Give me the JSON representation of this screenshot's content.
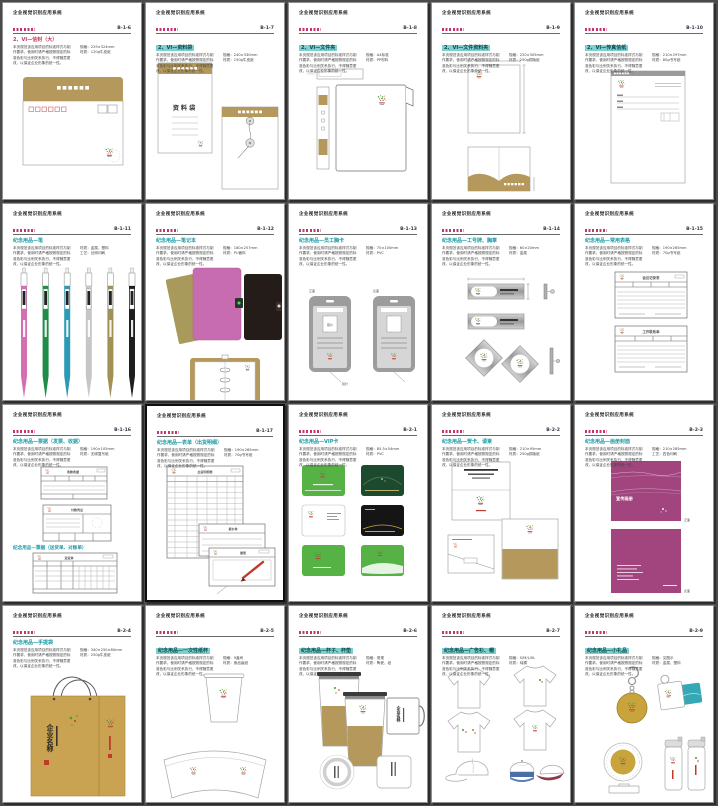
{
  "manual_title": "企业视觉识别应用系统",
  "common": {
    "desc": "本页规范该应用项目的标准样式与制作要求，使用时请严格按照规定的标准色彩与比例关系执行，不得随意更改，以保证企业形象的统一性。",
    "front_label": "正面",
    "back_label": "反面"
  },
  "colors": {
    "accent_red": "#c3356f",
    "accent_cyan": "#189aa6",
    "highlight_cyan": "#7fd0cf",
    "gold": "#b5995c",
    "card_green": "#56b244",
    "card_dark_green": "#1c4a2e",
    "panel_magenta": "#a2457e",
    "notebook_pink": "#c76cb0",
    "pen_colors": [
      "#d470b2",
      "#1f8c47",
      "#2b9ab4",
      "#c6c6c6",
      "#a29155",
      "#1e1e1e"
    ],
    "tag_teal": "#35a7b5",
    "cap_blue": "#4a6fa5",
    "cap_maroon": "#8e3a4a"
  },
  "pages": [
    {
      "code": "B-1-6",
      "title": "2、VI—信封（大）",
      "tstyle": "red",
      "spec1": "规格：229×324mm",
      "spec2": "材质：120g牛皮纸"
    },
    {
      "code": "B-1-7",
      "title": "2、VI—资料袋",
      "tstyle": "hl",
      "spec1": "规格：240×330mm",
      "spec2": "材质：150g牛皮纸",
      "labels": {
        "bag": "资料袋"
      }
    },
    {
      "code": "B-1-8",
      "title": "2、VI—文件夹",
      "tstyle": "hl",
      "spec1": "规格：A4标准",
      "spec2": "材质：PP材料"
    },
    {
      "code": "B-1-9",
      "title": "2、VI—文件资料夹",
      "tstyle": "hl",
      "spec1": "规格：220×305mm",
      "spec2": "材质：250g铜版纸"
    },
    {
      "code": "B-1-10",
      "title": "2、VI—传真信纸",
      "tstyle": "hl",
      "spec1": "规格：210×297mm",
      "spec2": "材质：80g书写纸"
    },
    {
      "code": "B-1-11",
      "title": "纪念用品—笔",
      "tstyle": "cyan",
      "spec1": "材质：金属、塑料",
      "spec2": "工艺：丝网印刷"
    },
    {
      "code": "B-1-12",
      "title": "纪念用品—笔记本",
      "tstyle": "cyan",
      "spec1": "规格：180×257mm",
      "spec2": "材质：PU面料"
    },
    {
      "code": "B-1-13",
      "title": "纪念用品—员工胸卡",
      "tstyle": "cyan",
      "spec1": "规格：70×100mm",
      "spec2": "材质：PVC",
      "labels": {
        "photo": "照片",
        "front": "正面",
        "back": "反面",
        "pin": "别针"
      }
    },
    {
      "code": "B-1-14",
      "title": "纪念用品—工号牌、胸章",
      "tstyle": "cyan",
      "spec1": "规格：60×20mm",
      "spec2": "材质：金属"
    },
    {
      "code": "B-1-15",
      "title": "纪念用品—常用表格",
      "tstyle": "cyan",
      "spec1": "规格：190×265mm",
      "spec2": "材质：70g书写纸",
      "labels": {
        "form1": "会议记录表",
        "form2": "工作联系单"
      }
    },
    {
      "code": "B-1-16",
      "title": "纪念用品—票据（发票、收据）",
      "tstyle": "cyan",
      "title2": "纪念用品—票据（送货单、对账单）",
      "spec1": "规格：190×105mm",
      "spec2": "材质：无碳复写纸",
      "labels": {
        "form1": "收款收据",
        "form2": "付款凭证",
        "form3": "送货单"
      }
    },
    {
      "code": "B-1-17",
      "title": "纪念用品—表单（出货明细）",
      "tstyle": "cyan",
      "spec1": "规格：190×265mm",
      "spec2": "材质：70g书写纸",
      "labels": {
        "table": "出货明细表",
        "form2": "报价单",
        "form3": "便笺"
      }
    },
    {
      "code": "B-2-1",
      "title": "纪念用品—VIP卡",
      "tstyle": "cyan",
      "spec1": "规格：85.5×54mm",
      "spec2": "材质：PVC"
    },
    {
      "code": "B-2-2",
      "title": "纪念用品—贺卡、请柬",
      "tstyle": "cyan",
      "spec1": "规格：210×95mm",
      "spec2": "材质：250g铜版纸"
    },
    {
      "code": "B-2-3",
      "title": "纪念用品—画册封面",
      "tstyle": "cyan",
      "spec1": "规格：210×285mm",
      "spec2": "工艺：四色印刷",
      "labels": {
        "cover": "宣传画册",
        "front": "正面",
        "back": "反面"
      }
    },
    {
      "code": "B-2-4",
      "title": "纪念用品—手提袋",
      "tstyle": "cyan",
      "spec1": "规格：340×250×80mm",
      "spec2": "材质：250g牛皮纸",
      "labels": {
        "brand": "企业名称"
      }
    },
    {
      "code": "B-2-5",
      "title": "纪念用品—一次性纸杯",
      "tstyle": "hl",
      "spec1": "规格：9盎司",
      "spec2": "材质：食品级纸"
    },
    {
      "code": "B-2-6",
      "title": "纪念用品—杯子、杯垫",
      "tstyle": "hl",
      "spec1": "规格：常规",
      "spec2": "材质：陶瓷、纸",
      "labels": {
        "brand": "企业名称"
      }
    },
    {
      "code": "B-2-7",
      "title": "纪念用品—广告衫、帽",
      "tstyle": "hl",
      "spec1": "规格：S/M/L/XL",
      "spec2": "材质：纯棉"
    },
    {
      "code": "B-2-9",
      "title": "纪念用品—小礼品",
      "tstyle": "hl",
      "spec1": "规格：见图示",
      "spec2": "材质：金属、塑料"
    }
  ]
}
